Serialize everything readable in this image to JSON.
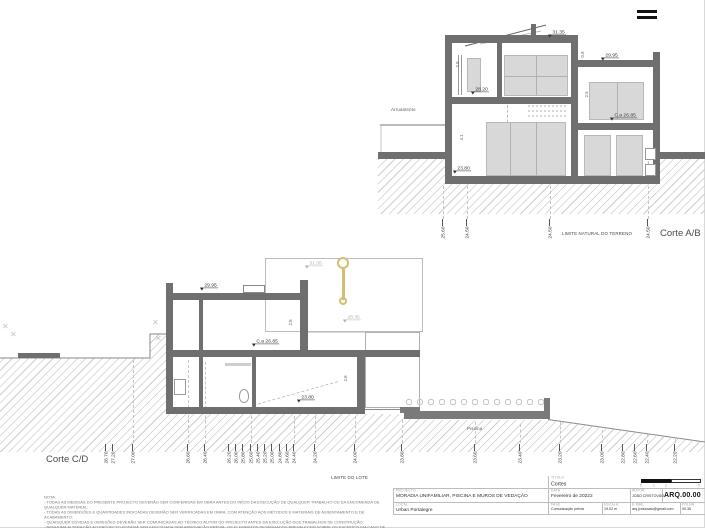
{
  "colors": {
    "wall": "#6f6f6f",
    "glass": "#d8d8d8",
    "hatch_line": "#cccccc",
    "accent_yellow": "#d4bd6e",
    "ink": "#3a3a3a",
    "faint": "#b0b0b0"
  },
  "corte_ab": {
    "name": "Corte A/B",
    "street_label": "Arruamento",
    "terrain_label": "LIMITE NATURAL DO TERRENO",
    "levels": {
      "roof": "31.35",
      "wing_roof": "29.95",
      "upper_floor": "28.20",
      "wing_mid": "C.a 26.85",
      "ground": "23.80"
    },
    "dims": {
      "upper_room": "2.8",
      "parapet": "0.8",
      "wing_room": "2.5",
      "lower_room": "4.1"
    },
    "ticks": [
      {
        "x": 443,
        "label": "25.60"
      },
      {
        "x": 467,
        "label": "24.50"
      },
      {
        "x": 550,
        "label": "24.50"
      },
      {
        "x": 648,
        "label": "24.50"
      }
    ]
  },
  "corte_cd": {
    "name": "Corte C/D",
    "lot_label": "LIMITE DO LOTE",
    "pool_label": "Piscina",
    "levels": {
      "roof_back": "31.35",
      "roof": "29.95",
      "terrace_back": "28.35",
      "mid": "C.a 26.85",
      "ground": "23.80"
    },
    "dims": {
      "upper_room": "2.8",
      "lower_room": "2.8"
    },
    "ticks": [
      {
        "x": 106,
        "label": "26.70"
      },
      {
        "x": 113,
        "label": "27.20"
      },
      {
        "x": 133,
        "label": "27.00"
      },
      {
        "x": 188,
        "label": "26.60"
      },
      {
        "x": 205,
        "label": "26.40"
      },
      {
        "x": 229,
        "label": "26.20"
      },
      {
        "x": 236,
        "label": "26.00"
      },
      {
        "x": 243,
        "label": "25.80"
      },
      {
        "x": 251,
        "label": "25.60"
      },
      {
        "x": 258,
        "label": "25.40"
      },
      {
        "x": 265,
        "label": "25.20"
      },
      {
        "x": 272,
        "label": "25.00"
      },
      {
        "x": 280,
        "label": "24.80"
      },
      {
        "x": 287,
        "label": "24.60"
      },
      {
        "x": 294,
        "label": "24.40"
      },
      {
        "x": 315,
        "label": "24.20"
      },
      {
        "x": 355,
        "label": "24.00"
      },
      {
        "x": 402,
        "label": "23.80"
      },
      {
        "x": 475,
        "label": "23.60"
      },
      {
        "x": 520,
        "label": "23.40"
      },
      {
        "x": 560,
        "label": "23.20"
      },
      {
        "x": 602,
        "label": "23.00"
      },
      {
        "x": 623,
        "label": "22.80"
      },
      {
        "x": 635,
        "label": "22.60"
      },
      {
        "x": 647,
        "label": "22.40"
      },
      {
        "x": 675,
        "label": "22.20"
      }
    ]
  },
  "title_block": {
    "project_label": "PROJECTO",
    "project": "MORADIA UNIFAMILIAR, PISCINA E MUROS DE VEDAÇÃO",
    "location_label": "LOCAL",
    "location": "Urban Portalegre",
    "sheet_title_label": "TÍTULO",
    "sheet_title": "Cortes",
    "date_label": "DATA",
    "date": "Fevereiro de 20222",
    "author_label": "AUTOR",
    "author": "JOÃO CRISTÓVÃO",
    "drawing_number": "ARQ.00.00",
    "phase_label": "FASE",
    "phase": "Comunicação prévia",
    "scale_label": "ESCALA",
    "scale": "19.02 m",
    "email_label": "E-MAIL",
    "email": "arq.jcristovao@gmail.com",
    "sheet_label": "FOLHA",
    "sheet": "00.35",
    "scale_bar_numbers": [
      "0",
      "1",
      "2",
      "5"
    ]
  },
  "notes": {
    "title": "NOTA:",
    "lines": [
      "- TODAS AS MEDIDAS DO PRESENTE PROJECTO DEVERÃO SER CONFERIDAS EM OBRA ANTES DO INÍCIO DA EXECUÇÃO DE QUALQUER TRABALHO OU DA ENCOMENDA DE QUALQUER MATERIAL;",
      "- TODAS AS DIMENSÕES E QUANTIDADES INDICADAS DEVERÃO SER VERIFICADAS EM OBRA, COM ATENÇÃO AOS MÉTODOS E MATERIAIS DE ASSENTAMENTO E DE ACABAMENTO;",
      "- QUAISQUER DÚVIDAS E OMISSÕES DEVERÃO SER COMUNICADAS AO TÉCNICO AUTOR DO PROJECTO ANTES DA EXECUÇÃO DOS TRABALHOS DE CONSTRUÇÃO;",
      "- NENHUMA ALTERAÇÃO AO PROJECTO PODERÁ SER EFECTUADA SEM APROVAÇÃO PRÉVIA; OS ELEMENTOS DESENHADOS PREVALECEM SOBRE OS ESCRITOS EM CASO DE DÚVIDA."
    ]
  }
}
